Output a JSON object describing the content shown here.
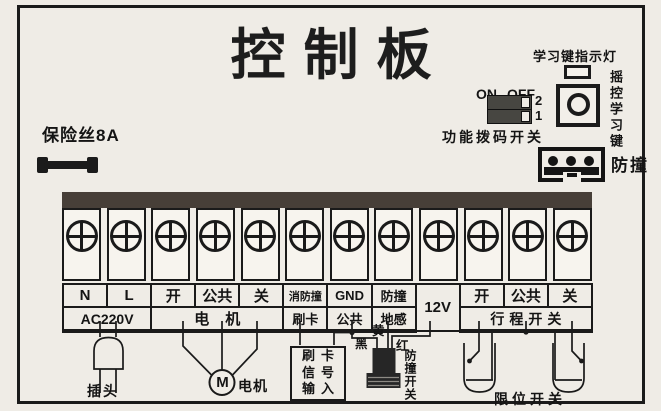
{
  "title": "控制板",
  "fuse_label": "保险丝8A",
  "learn": {
    "indicator_label": "学习键指示灯",
    "button_label": "摇控学习键"
  },
  "dip": {
    "on": "ON",
    "off": "OFF",
    "pos2": "2",
    "pos1": "1",
    "caption": "功能拨码开关"
  },
  "bump_connector_label": "防撞",
  "terminals": {
    "count": 12,
    "row1": [
      "N",
      "L",
      "开",
      "公共",
      "关",
      "消防撞",
      "GND",
      "防撞",
      "12V",
      "开",
      "公共",
      "关"
    ],
    "row2": {
      "ac220v": "AC220V",
      "motor_group": "电机",
      "card": "刷卡",
      "common": "公共",
      "ground_sense": "地感",
      "travel_group": "行程开关"
    }
  },
  "wiring": {
    "plug": "插头",
    "motor_m": "M",
    "motor": "电机",
    "card_box": [
      "刷卡",
      "信号",
      "输入"
    ],
    "yellow": "黄",
    "black": "黑",
    "red": "红",
    "bump_switch": "防撞开关",
    "limit_switch": "限位开关"
  },
  "colors": {
    "paper": "#efece6",
    "line": "#1a1a1a",
    "strip_bar": "#473f38",
    "sensor": "#262626"
  }
}
